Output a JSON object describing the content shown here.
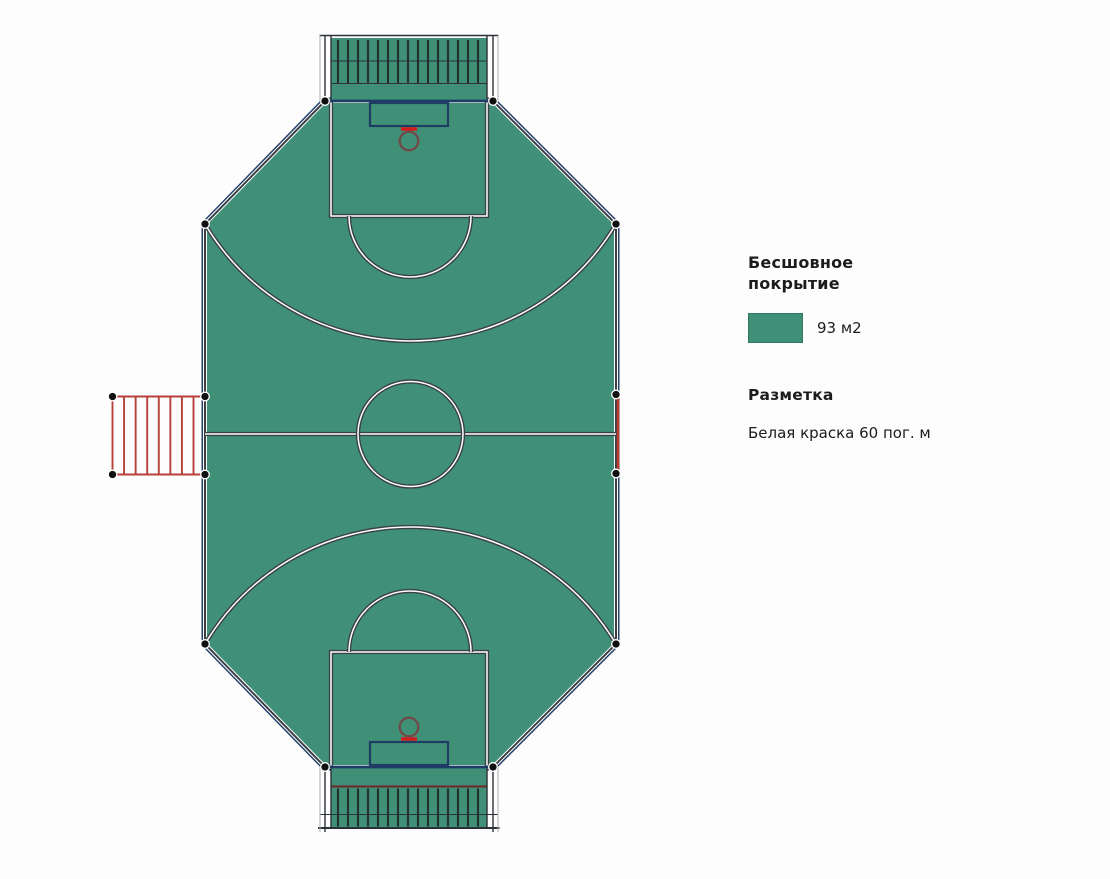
{
  "legend": {
    "coating_title": "Бесшовное покрытие",
    "coating_value": "93 м2",
    "marking_title": "Разметка",
    "marking_value": "Белая краска 60 пог. м"
  },
  "colors": {
    "court_green": "#3F9077",
    "line_dark": "#3A4045",
    "line_navy": "#1E3C64",
    "outer_navy": "#26406B",
    "red": "#C0392B",
    "ladder_red": "#B8403A",
    "backboard_red": "#D11F1F",
    "hoop_ring": "#6F4A47",
    "band_bar": "#25312D",
    "maroon": "#6E2626",
    "dot_black": "#101010",
    "background": "#FDFDFD",
    "text": "#1C1C1C"
  }
}
